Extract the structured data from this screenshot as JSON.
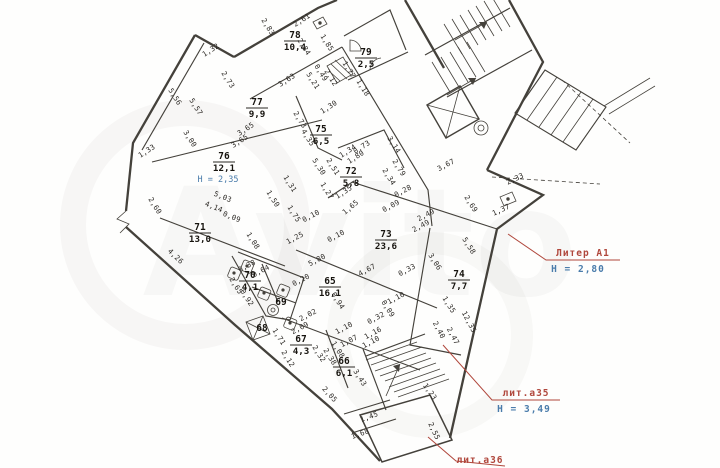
{
  "watermark": {
    "brand": "Avito"
  },
  "colors": {
    "red": "#b0473c",
    "blue": "#4a7cab",
    "wall": "#44413b",
    "dim": "#2b2824"
  },
  "plan": {
    "annotations": {
      "liter_a1": {
        "label": "Литер А1",
        "height": "Н = 2,80"
      },
      "lit_a35": {
        "label": "лит.а35",
        "height": "Н = 3,49"
      },
      "lit_a36": {
        "label": "лит.а36"
      }
    },
    "rooms": [
      {
        "number": "78",
        "area": "10,4",
        "x": 295,
        "y": 40
      },
      {
        "number": "79",
        "area": "2,5",
        "x": 366,
        "y": 57
      },
      {
        "number": "77",
        "area": "9,9",
        "x": 257,
        "y": 107
      },
      {
        "number": "75",
        "area": "6,5",
        "x": 321,
        "y": 134
      },
      {
        "number": "76",
        "area": "12,1",
        "x": 224,
        "y": 161,
        "height": "Н = 2,35"
      },
      {
        "number": "72",
        "area": "5,8",
        "x": 351,
        "y": 176
      },
      {
        "number": "71",
        "area": "13,0",
        "x": 200,
        "y": 232
      },
      {
        "number": "73",
        "area": "23,6",
        "x": 386,
        "y": 239
      },
      {
        "number": "74",
        "area": "7,7",
        "x": 459,
        "y": 279
      },
      {
        "number": "70",
        "area": "4,1",
        "x": 250,
        "y": 280
      },
      {
        "number": "69",
        "area": "",
        "x": 281,
        "y": 307
      },
      {
        "number": "68",
        "area": "",
        "x": 262,
        "y": 333
      },
      {
        "number": "65",
        "area": "16,1",
        "x": 330,
        "y": 286
      },
      {
        "number": "67",
        "area": "4,3",
        "x": 301,
        "y": 344
      },
      {
        "number": "66",
        "area": "6,1",
        "x": 344,
        "y": 366
      }
    ],
    "dimensions": [
      {
        "t": "2,61",
        "x": 303,
        "y": 22,
        "r": -33
      },
      {
        "t": "2,83",
        "x": 266,
        "y": 28,
        "r": 58
      },
      {
        "t": "1,32",
        "x": 212,
        "y": 52,
        "r": -33
      },
      {
        "t": "2,84",
        "x": 302,
        "y": 48,
        "r": 58
      },
      {
        "t": "1,85",
        "x": 325,
        "y": 44,
        "r": 58
      },
      {
        "t": "5,21",
        "x": 311,
        "y": 82,
        "r": 58
      },
      {
        "t": "0,49",
        "x": 319,
        "y": 74,
        "r": 58
      },
      {
        "t": "2,12",
        "x": 329,
        "y": 79,
        "r": 58
      },
      {
        "t": "1,77",
        "x": 347,
        "y": 71,
        "r": 58
      },
      {
        "t": "1,18",
        "x": 361,
        "y": 89,
        "r": 58
      },
      {
        "t": "3,63",
        "x": 288,
        "y": 82,
        "r": -33
      },
      {
        "t": "2,73",
        "x": 226,
        "y": 81,
        "r": 58
      },
      {
        "t": "5,56",
        "x": 173,
        "y": 98,
        "r": 58
      },
      {
        "t": "5,57",
        "x": 194,
        "y": 108,
        "r": 58
      },
      {
        "t": "3,00",
        "x": 188,
        "y": 140,
        "r": 58
      },
      {
        "t": "1,33",
        "x": 148,
        "y": 153,
        "r": -33
      },
      {
        "t": "3,65",
        "x": 247,
        "y": 131,
        "r": -33
      },
      {
        "t": "3,65",
        "x": 241,
        "y": 143,
        "r": -33
      },
      {
        "t": "2,73",
        "x": 298,
        "y": 121,
        "r": 58
      },
      {
        "t": "4,35",
        "x": 306,
        "y": 139,
        "r": 58
      },
      {
        "t": "1,30",
        "x": 330,
        "y": 109,
        "r": -33
      },
      {
        "t": "2,60",
        "x": 153,
        "y": 207,
        "r": 58
      },
      {
        "t": "5,03",
        "x": 222,
        "y": 199,
        "r": 22
      },
      {
        "t": "4,14",
        "x": 213,
        "y": 209,
        "r": 22
      },
      {
        "t": "0,09",
        "x": 231,
        "y": 219,
        "r": 22
      },
      {
        "t": "4,26",
        "x": 174,
        "y": 258,
        "r": 44
      },
      {
        "t": "1,50",
        "x": 271,
        "y": 200,
        "r": 58
      },
      {
        "t": "1,31",
        "x": 288,
        "y": 185,
        "r": 58
      },
      {
        "t": "5,30",
        "x": 317,
        "y": 168,
        "r": 58
      },
      {
        "t": "2,51",
        "x": 331,
        "y": 168,
        "r": 58
      },
      {
        "t": "1,34",
        "x": 349,
        "y": 153,
        "r": -33
      },
      {
        "t": "0,73",
        "x": 363,
        "y": 149,
        "r": -33
      },
      {
        "t": "1,80",
        "x": 357,
        "y": 159,
        "r": -33
      },
      {
        "t": "3,14",
        "x": 392,
        "y": 146,
        "r": 58
      },
      {
        "t": "2,79",
        "x": 397,
        "y": 169,
        "r": 58
      },
      {
        "t": "2,34",
        "x": 387,
        "y": 178,
        "r": 58
      },
      {
        "t": "1,27",
        "x": 325,
        "y": 192,
        "r": 58
      },
      {
        "t": "1,35",
        "x": 345,
        "y": 194,
        "r": -33
      },
      {
        "t": "1,65",
        "x": 352,
        "y": 209,
        "r": -40
      },
      {
        "t": "3,67",
        "x": 447,
        "y": 167,
        "r": -28
      },
      {
        "t": "2,33",
        "x": 516,
        "y": 181,
        "r": -25
      },
      {
        "t": "2,69",
        "x": 469,
        "y": 205,
        "r": 58
      },
      {
        "t": "1,37",
        "x": 502,
        "y": 212,
        "r": -25
      },
      {
        "t": "0,28",
        "x": 404,
        "y": 193,
        "r": -28
      },
      {
        "t": "0,09",
        "x": 392,
        "y": 208,
        "r": -28
      },
      {
        "t": "2,49",
        "x": 427,
        "y": 217,
        "r": -28
      },
      {
        "t": "2,49",
        "x": 422,
        "y": 228,
        "r": -28
      },
      {
        "t": "1,75",
        "x": 292,
        "y": 215,
        "r": 58
      },
      {
        "t": "0,10",
        "x": 312,
        "y": 218,
        "r": -28
      },
      {
        "t": "0,10",
        "x": 337,
        "y": 238,
        "r": -28
      },
      {
        "t": "1,25",
        "x": 296,
        "y": 240,
        "r": -28
      },
      {
        "t": "1,08",
        "x": 251,
        "y": 242,
        "r": 58
      },
      {
        "t": "5,80",
        "x": 318,
        "y": 262,
        "r": -28
      },
      {
        "t": "4,67",
        "x": 368,
        "y": 272,
        "r": -28
      },
      {
        "t": "0,33",
        "x": 408,
        "y": 272,
        "r": -28
      },
      {
        "t": "3,06",
        "x": 433,
        "y": 263,
        "r": 58
      },
      {
        "t": "5,58",
        "x": 467,
        "y": 247,
        "r": 58
      },
      {
        "t": "12,35",
        "x": 467,
        "y": 323,
        "r": 62
      },
      {
        "t": "2,40",
        "x": 437,
        "y": 331,
        "r": 62
      },
      {
        "t": "2,47",
        "x": 451,
        "y": 337,
        "r": 62
      },
      {
        "t": "1,35",
        "x": 447,
        "y": 306,
        "r": 58
      },
      {
        "t": "0,20",
        "x": 302,
        "y": 282,
        "r": -28
      },
      {
        "t": "2,65",
        "x": 234,
        "y": 287,
        "r": 58
      },
      {
        "t": "0,38",
        "x": 248,
        "y": 268,
        "r": -28
      },
      {
        "t": "0,64",
        "x": 262,
        "y": 273,
        "r": -28
      },
      {
        "t": "0,92",
        "x": 245,
        "y": 299,
        "r": 58
      },
      {
        "t": "2,02",
        "x": 309,
        "y": 317,
        "r": -28
      },
      {
        "t": "2,09",
        "x": 301,
        "y": 330,
        "r": -28
      },
      {
        "t": "1,71",
        "x": 277,
        "y": 338,
        "r": 58
      },
      {
        "t": "0,94",
        "x": 336,
        "y": 302,
        "r": 58
      },
      {
        "t": "0,09",
        "x": 386,
        "y": 310,
        "r": 58
      },
      {
        "t": "0,32",
        "x": 377,
        "y": 320,
        "r": -28
      },
      {
        "t": "1,10",
        "x": 345,
        "y": 330,
        "r": -28
      },
      {
        "t": "1,16",
        "x": 374,
        "y": 335,
        "r": -28
      },
      {
        "t": "1,07",
        "x": 350,
        "y": 343,
        "r": -28
      },
      {
        "t": "1,10",
        "x": 372,
        "y": 344,
        "r": -28
      },
      {
        "t": "1,08",
        "x": 336,
        "y": 351,
        "r": 58
      },
      {
        "t": "1,10",
        "x": 397,
        "y": 300,
        "r": -28
      },
      {
        "t": "2,32",
        "x": 317,
        "y": 355,
        "r": 58
      },
      {
        "t": "2,38",
        "x": 328,
        "y": 358,
        "r": 58
      },
      {
        "t": "2,12",
        "x": 286,
        "y": 360,
        "r": 58
      },
      {
        "t": "3,43",
        "x": 358,
        "y": 379,
        "r": 58
      },
      {
        "t": "2,05",
        "x": 328,
        "y": 396,
        "r": 48
      },
      {
        "t": "1,45",
        "x": 370,
        "y": 419,
        "r": -20
      },
      {
        "t": "1,68",
        "x": 361,
        "y": 436,
        "r": -20
      },
      {
        "t": "1,23",
        "x": 428,
        "y": 393,
        "r": 55
      },
      {
        "t": "2,55",
        "x": 432,
        "y": 432,
        "r": 65
      }
    ]
  }
}
